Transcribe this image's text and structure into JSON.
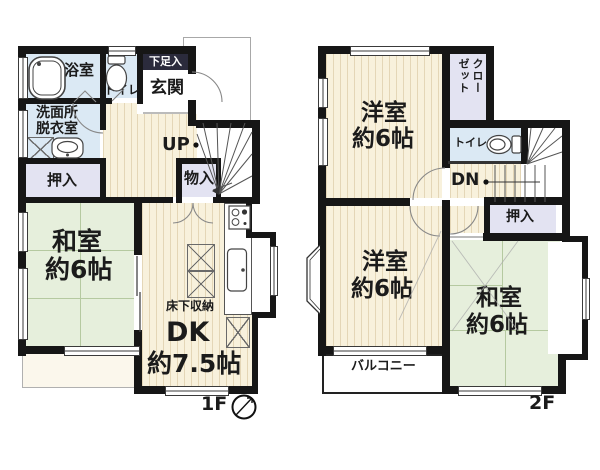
{
  "f1": {
    "floor_label": "1F",
    "bath": "浴室",
    "toilet": "トイレ",
    "shoe": "下足入",
    "genkan": "玄関",
    "wash1": "洗面所",
    "wash2": "脱衣室",
    "oshiire": "押入",
    "monoire": "物入",
    "up": "UP",
    "washitsu": "和室",
    "washitsu_size": "約6帖",
    "dk": "DK",
    "dk_size": "約7.5帖",
    "yukashita": "床下収納"
  },
  "f2": {
    "floor_label": "2F",
    "yoshitsu_a": "洋室",
    "yoshitsu_a_size": "約6帖",
    "closet": "クローゼット",
    "toilet": "トイレ",
    "dn": "DN",
    "oshiire": "押入",
    "yoshitsu_b": "洋室",
    "yoshitsu_b_size": "約6帖",
    "washitsu": "和室",
    "washitsu_size": "約6帖",
    "balcony": "バルコニー"
  },
  "colors": {
    "wall": "#161616",
    "tatami_green": "#e6efdc",
    "flooring_cream": "#f8f1dc",
    "water_blue": "#dbe9f4",
    "closet_lavender": "#e3e3f2",
    "shoe_box_bar": "#2b2b3c"
  }
}
